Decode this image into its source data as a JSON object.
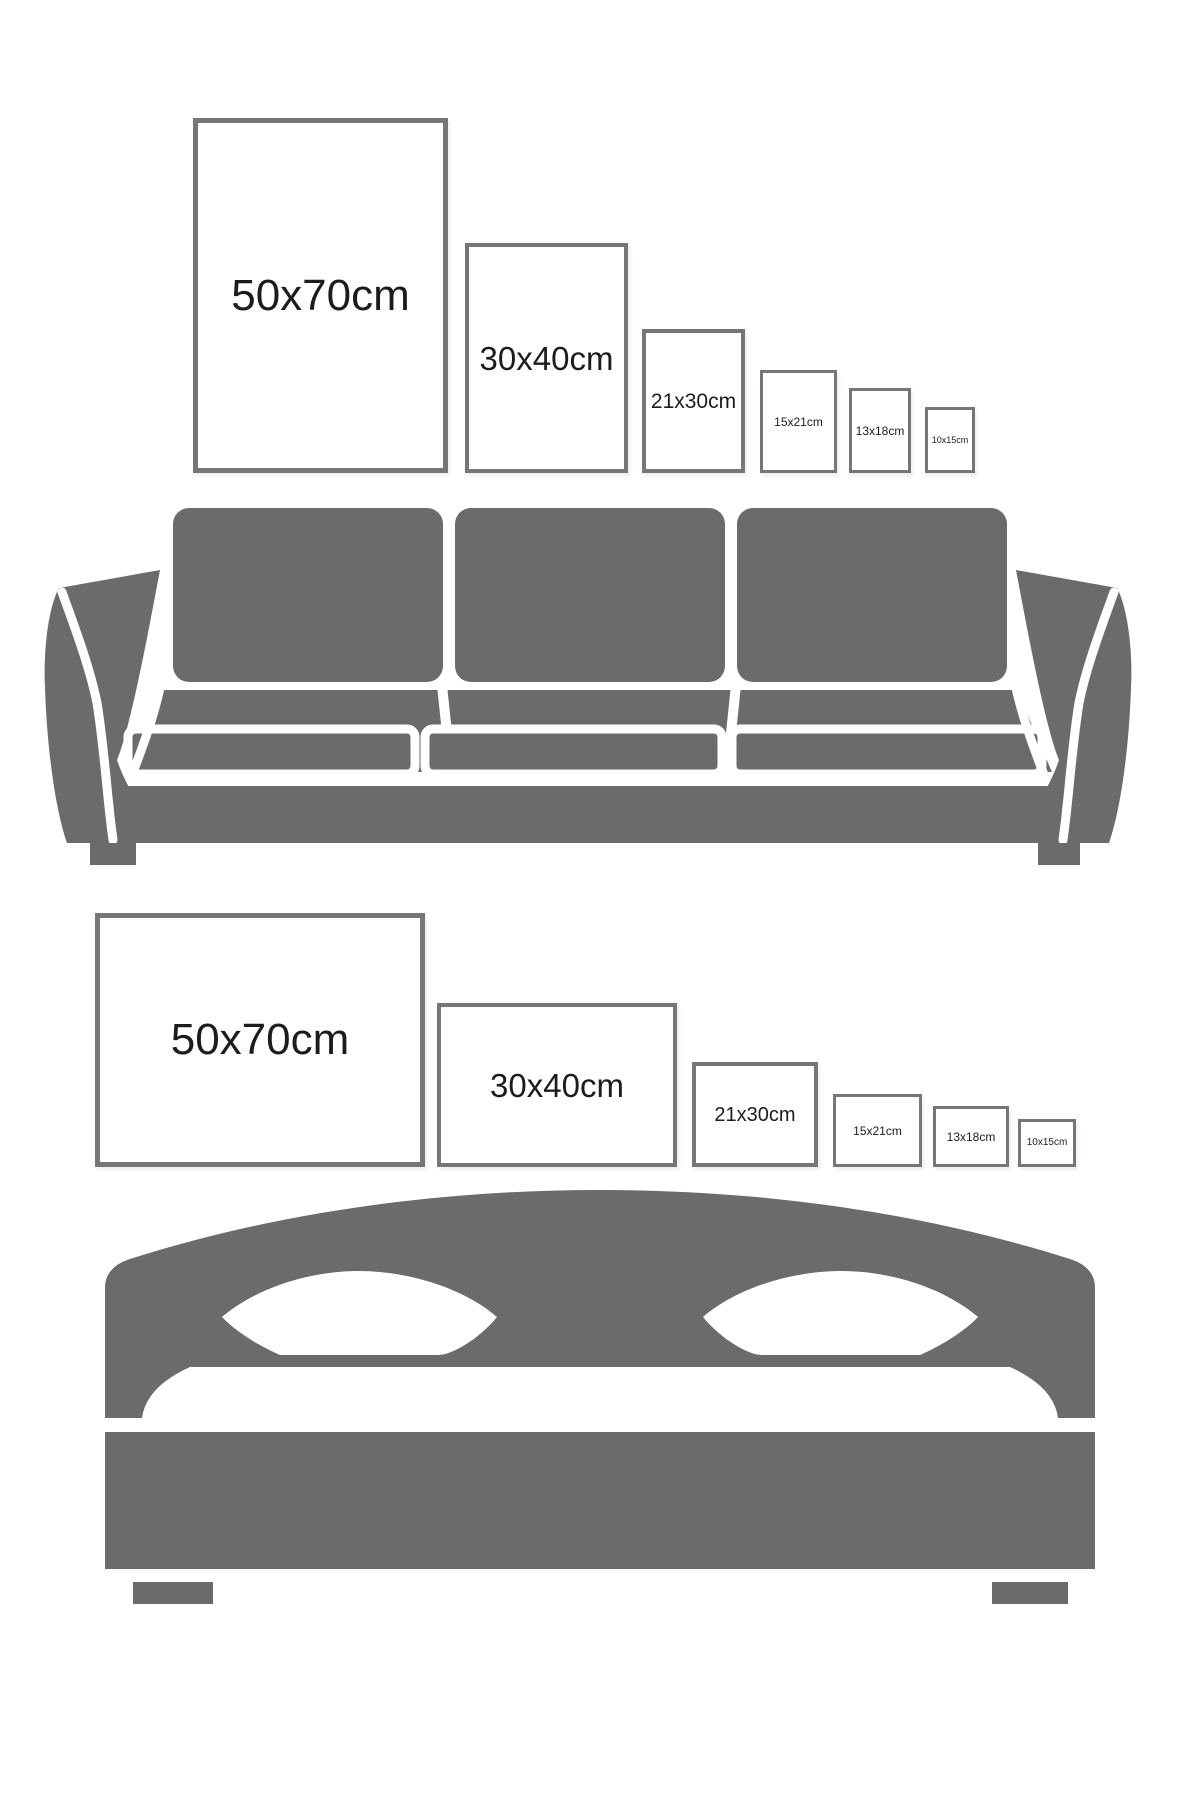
{
  "colors": {
    "bg": "#ffffff",
    "furniture": "#6b6b6b",
    "frame_border": "#767676",
    "label": "#1c1c1c"
  },
  "portrait_row": {
    "name": "poster sizes above sofa",
    "furniture": "sofa-silhouette",
    "frames": [
      {
        "label": "50x70cm",
        "width_cm": 50,
        "height_cm": 70
      },
      {
        "label": "30x40cm",
        "width_cm": 30,
        "height_cm": 40
      },
      {
        "label": "21x30cm",
        "width_cm": 21,
        "height_cm": 30
      },
      {
        "label": "15x21cm",
        "width_cm": 15,
        "height_cm": 21
      },
      {
        "label": "13x18cm",
        "width_cm": 13,
        "height_cm": 18
      },
      {
        "label": "10x15cm",
        "width_cm": 10,
        "height_cm": 15
      }
    ]
  },
  "landscape_row": {
    "name": "poster sizes above bed",
    "furniture": "bed-silhouette",
    "frames": [
      {
        "label": "50x70cm",
        "width_cm": 70,
        "height_cm": 50
      },
      {
        "label": "30x40cm",
        "width_cm": 40,
        "height_cm": 30
      },
      {
        "label": "21x30cm",
        "width_cm": 30,
        "height_cm": 21
      },
      {
        "label": "15x21cm",
        "width_cm": 21,
        "height_cm": 15
      },
      {
        "label": "13x18cm",
        "width_cm": 18,
        "height_cm": 13
      },
      {
        "label": "10x15cm",
        "width_cm": 15,
        "height_cm": 10
      }
    ]
  }
}
